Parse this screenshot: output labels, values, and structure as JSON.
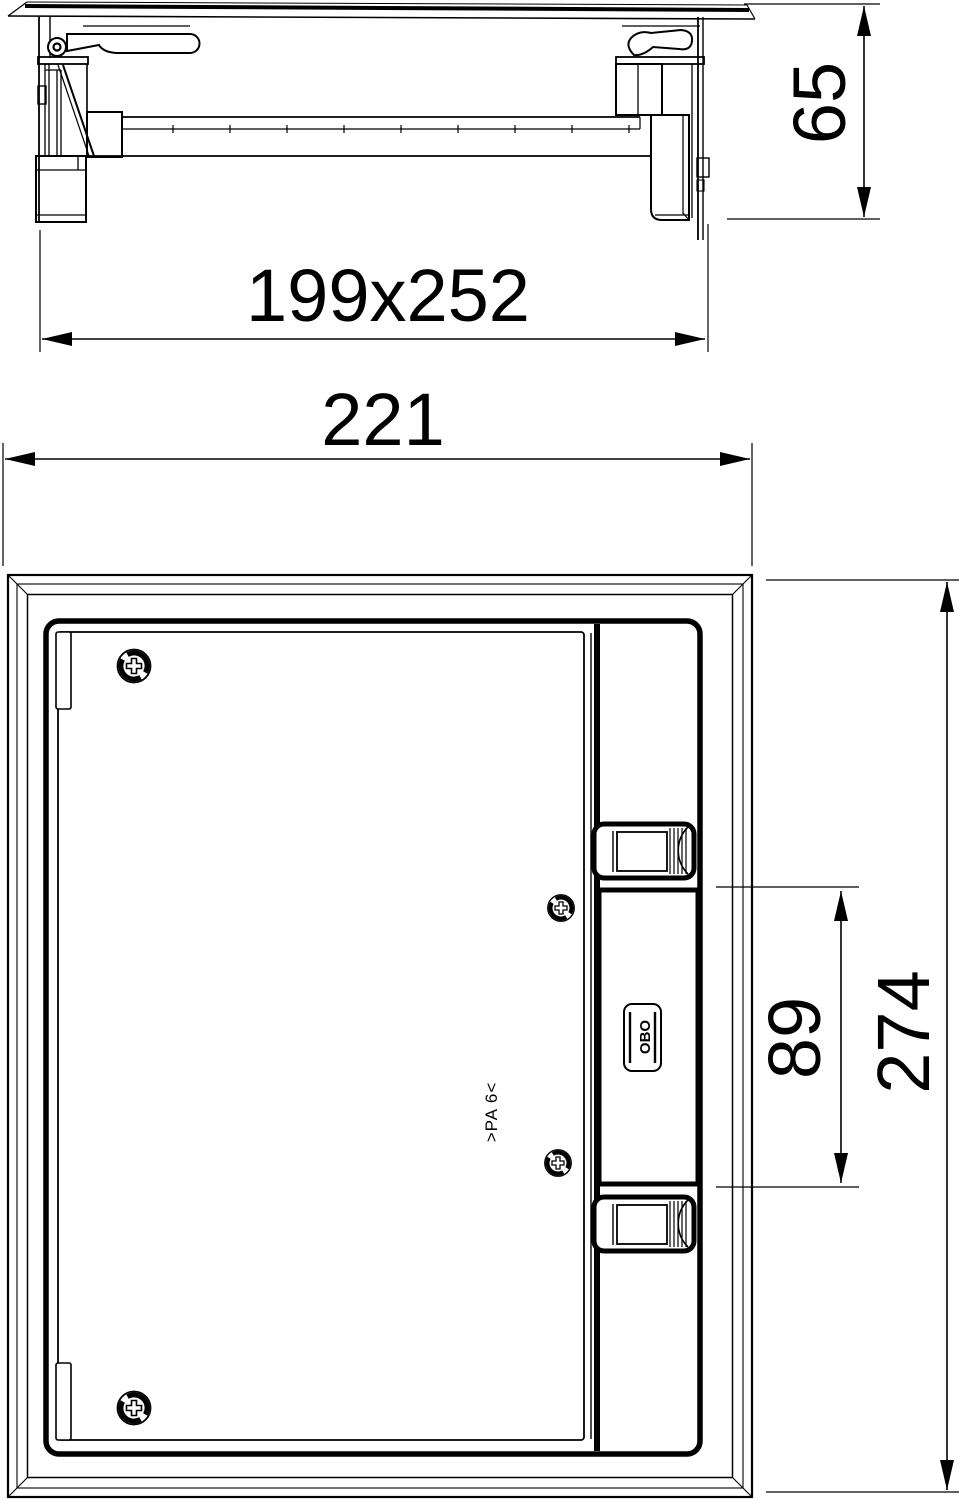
{
  "drawing": {
    "background": "#ffffff",
    "line_color": "#000000"
  },
  "dimensions": {
    "section_view": {
      "height": "65",
      "box_size": "199x252",
      "overall_width": "221"
    },
    "plan_view": {
      "overall_length": "274",
      "device_cutout": "89"
    }
  },
  "markings": {
    "brand": "OBO",
    "material": ">PA 6<"
  }
}
